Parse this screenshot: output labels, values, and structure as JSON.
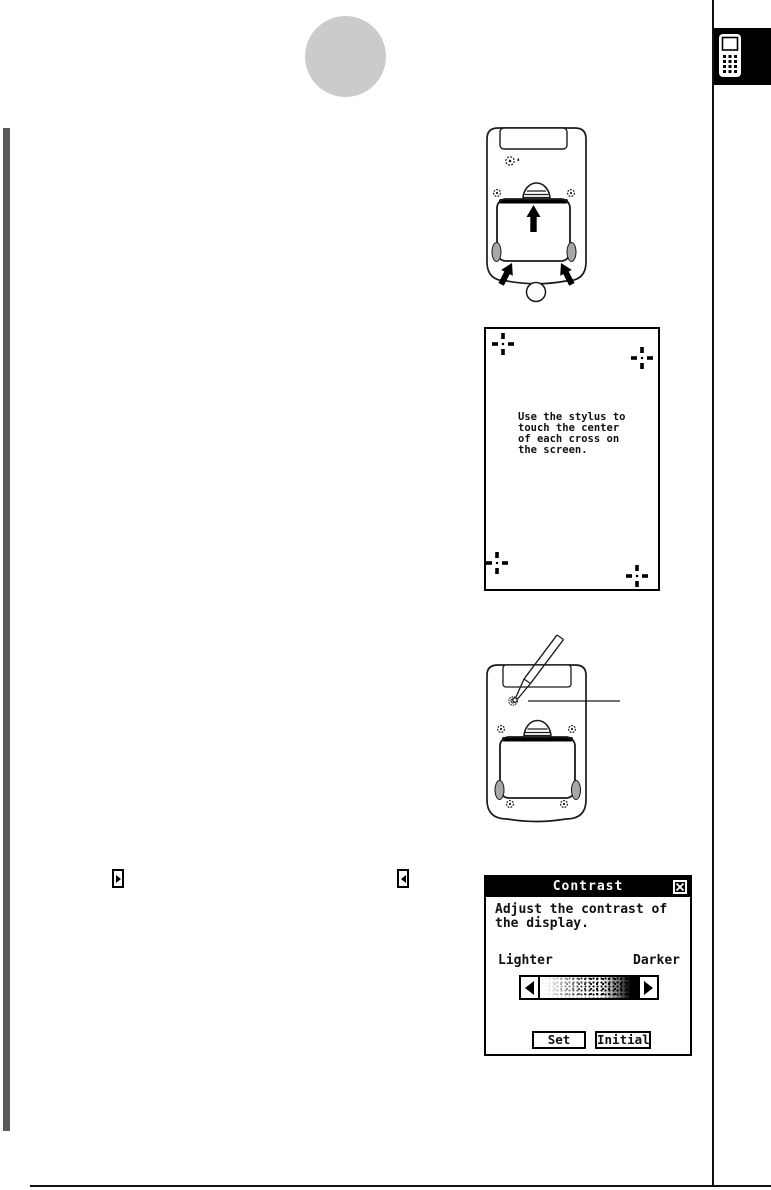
{
  "page_type": "scanned-manual-page",
  "side_tab": {
    "icon": "calculator-icon"
  },
  "calibration_screen": {
    "message": "Use the stylus to\ntouch the center\nof each cross on\nthe screen."
  },
  "contrast_dialog": {
    "title": "Contrast",
    "message": "Adjust the contrast of\nthe display.",
    "lighter_label": "Lighter",
    "darker_label": "Darker",
    "set_label": "Set",
    "initial_label": "Initial"
  },
  "icons": {
    "side_tab": "calculator-icon",
    "dialog_close": "close-icon",
    "slider_left_arrow": "left-arrow-icon",
    "slider_right_arrow": "right-arrow-icon",
    "inline_scroll_right": "right-arrow-button-icon",
    "inline_scroll_left": "left-arrow-button-icon",
    "calibration_cross": "calibration-cross-icon",
    "figure_arrows": "up-arrow-icon"
  },
  "colors": {
    "left_bar": "#5a5a5a",
    "page_bubble": "#cbcbcb",
    "tab_bg": "#000000",
    "dialog_title_bg": "#000000",
    "line_black": "#111111",
    "foot_gray": "#a8a8a8"
  }
}
